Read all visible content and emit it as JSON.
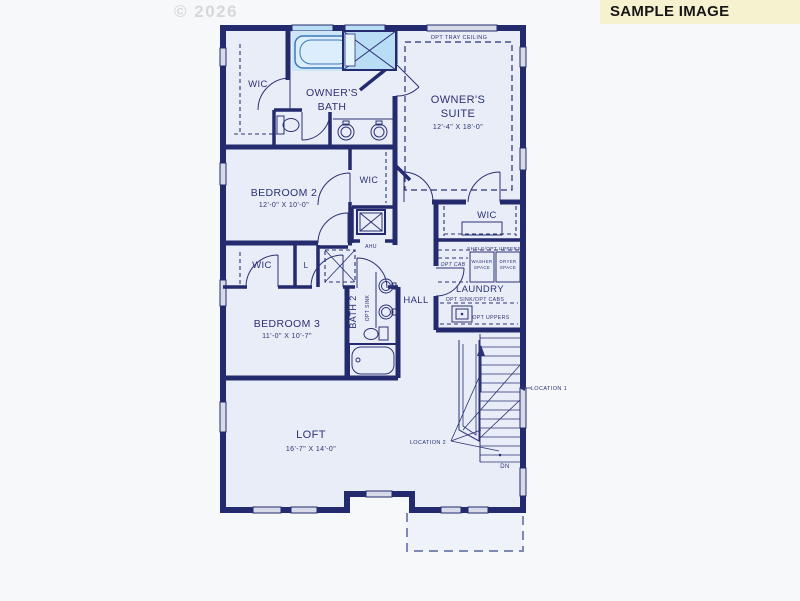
{
  "page": {
    "watermark": "© 2026",
    "banner": "SAMPLE IMAGE"
  },
  "colors": {
    "page_bg": "#f7f8fa",
    "wall": "#232a6d",
    "room_fill": "#e9edf7",
    "label": "#2b3274",
    "fixture_blue": "#b9ddf4",
    "tub_blue": "#cde7f8",
    "tub_line": "#3c78bd",
    "window_gray": "#d7dbe9",
    "banner_bg": "#f6f1cf",
    "banner_text": "#161616",
    "watermark": "#d8d8d8",
    "dashed_area": "#8089b4"
  },
  "rooms": {
    "owners_suite": {
      "opt": "OPT TRAY CEILING",
      "line1": "OWNER'S",
      "line2": "SUITE",
      "dims": "12'-4\" X 18'-0\""
    },
    "owners_bath": {
      "line1": "OWNER'S",
      "line2": "BATH"
    },
    "wic_owner": {
      "label": "WIC"
    },
    "wic_mid": {
      "label": "WIC"
    },
    "wic_right": {
      "label": "WIC"
    },
    "wic_bed3": {
      "label": "WIC"
    },
    "linen": {
      "label": "L"
    },
    "ahu": {
      "label": "AHU"
    },
    "bedroom2": {
      "label": "BEDROOM 2",
      "dims": "12'-0\" X 10'-0\""
    },
    "bedroom3": {
      "label": "BEDROOM 3",
      "dims": "11'-0\" X 10'-7\""
    },
    "bath2": {
      "label": "BATH 2",
      "opt_sink": "OPT SINK"
    },
    "hall": {
      "label": "HALL"
    },
    "laundry": {
      "label": "LAUNDRY",
      "shelf": "SHELF/OPT UPPERS",
      "washer1": "WASHER",
      "washer2": "SPACE",
      "dryer1": "DRYER",
      "dryer2": "SPACE",
      "opt_cab": "OPT CAB",
      "opt_sink": "OPT SINK/OPT CABS",
      "opt_uppers": "OPT UPPERS"
    },
    "loft": {
      "label": "LOFT",
      "dims": "16'-7\" X 14'-0\""
    },
    "stairs": {
      "dn": "DN",
      "loc1": "LOCATION 1",
      "loc2": "LOCATION 2"
    }
  }
}
